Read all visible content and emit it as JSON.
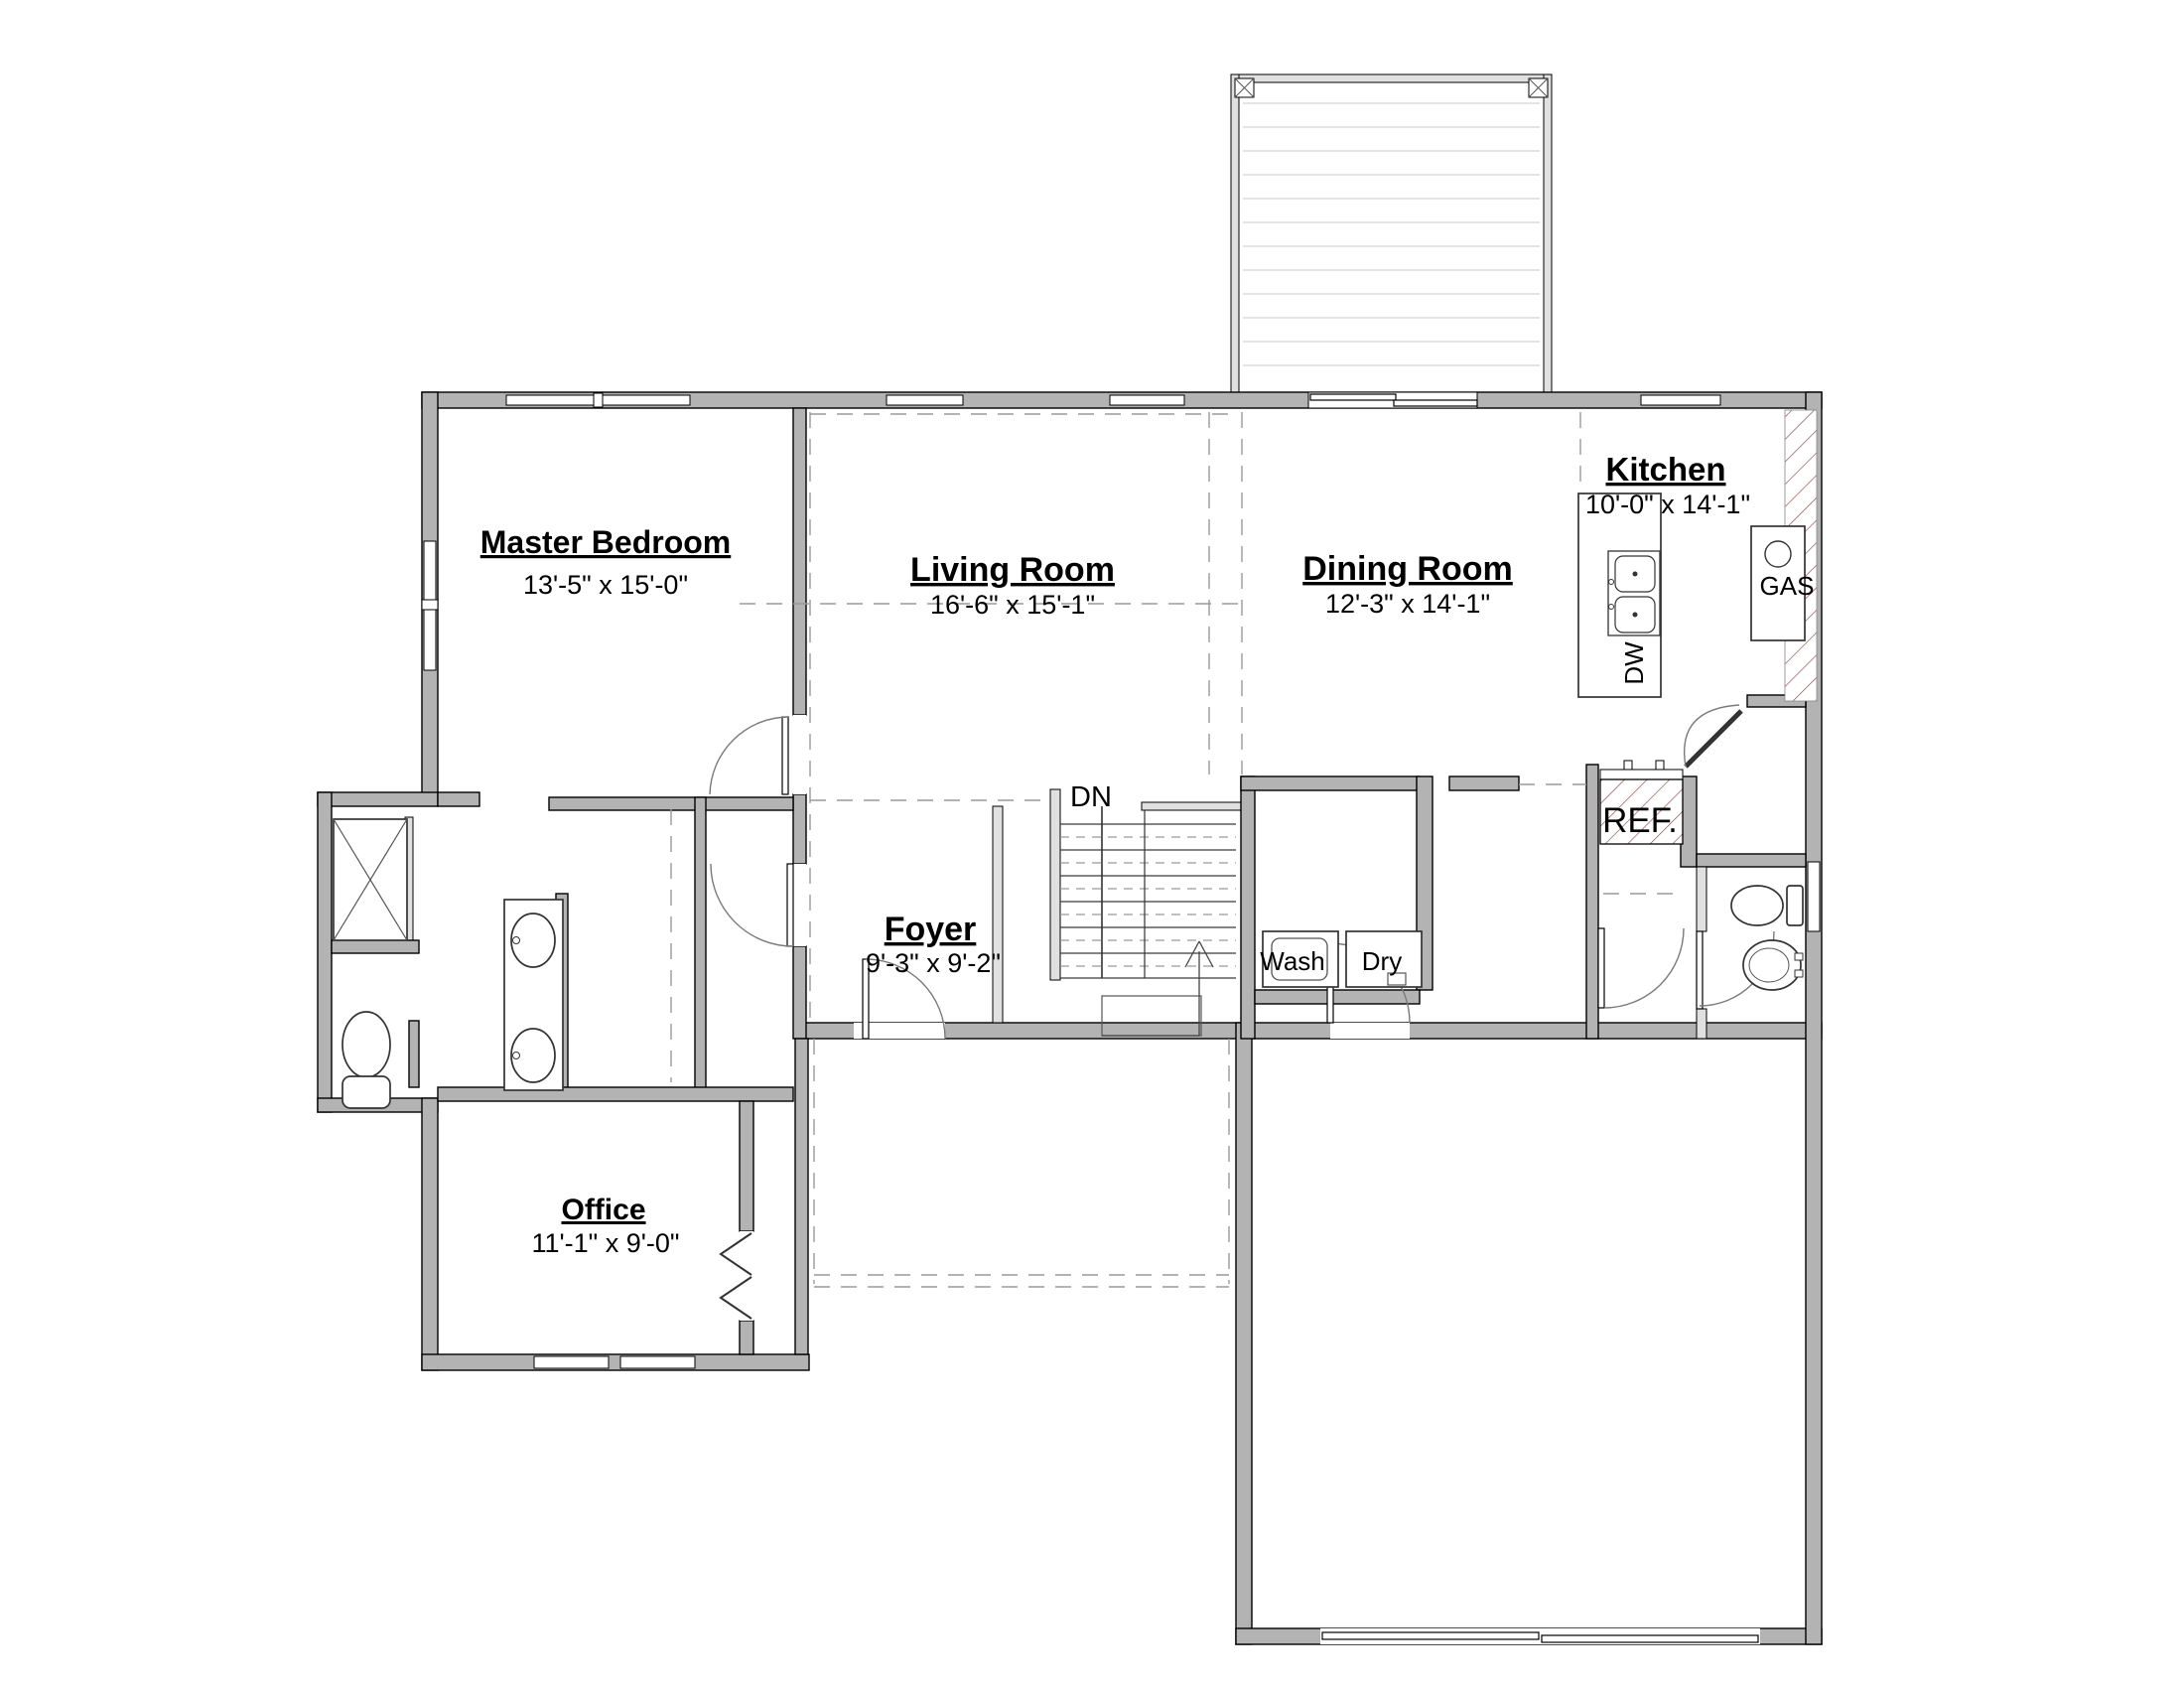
{
  "plan": {
    "rooms": [
      {
        "name": "Master Bedroom",
        "dims": "13'-5\" x 15'-0\""
      },
      {
        "name": "Living Room",
        "dims": "16'-6\" x 15'-1\""
      },
      {
        "name": "Dining Room",
        "dims": "12'-3\" x 14'-1\""
      },
      {
        "name": "Kitchen",
        "dims": "10'-0\" x 14'-1\""
      },
      {
        "name": "Foyer",
        "dims": "9'-3\" x 9'-2\""
      },
      {
        "name": "Office",
        "dims": "11'-1\" x 9'-0\""
      }
    ],
    "labels": {
      "stairs": "DN",
      "washer": "Wash",
      "dryer": "Dry",
      "refrigerator": "REF.",
      "range": "GAS",
      "dishwasher": "DW"
    },
    "colors": {
      "wall_fill": "#b3b3b3",
      "wall_stroke": "#000000",
      "hatch": "#8a4a4a",
      "dashed": "#9a9a9a",
      "background": "#ffffff"
    }
  }
}
